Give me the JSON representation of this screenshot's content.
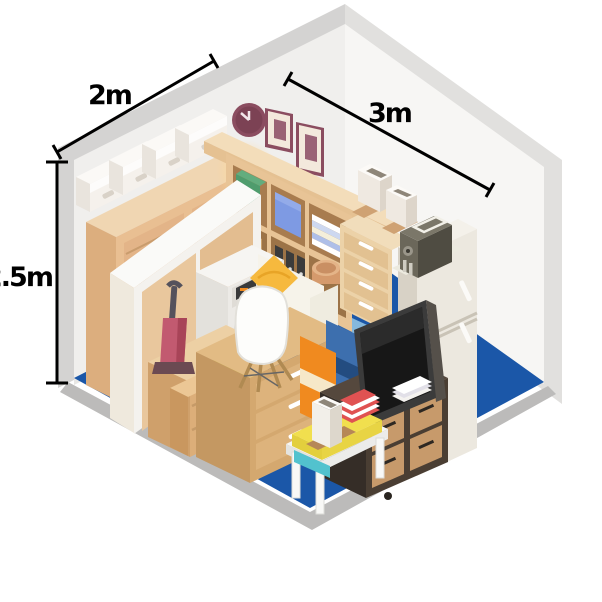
{
  "illustration": "isometric storage unit filled with household furniture and boxes",
  "dimensions": {
    "width_label": "2m",
    "depth_label": "3m",
    "height_label": "2.5m"
  },
  "colors": {
    "floor": "#1b57a8",
    "wall": "#f0efed",
    "wall_edge": "#d4d3d2",
    "wood": "#e9c195",
    "wood_dark": "#c99a68",
    "cardboard": "#d4a86f",
    "accent_yellow": "#f6b93e",
    "accent_orange": "#f08a1f",
    "accent_blue": "#3d6fae",
    "accent_teal": "#52c2ce",
    "accent_green": "#4f9c6d",
    "accent_chartreuse": "#ccd43e",
    "accent_plum": "#8b4d60",
    "appliance_white": "#eceae6",
    "fridge_cream": "#ece8df",
    "tv_dark": "#3b3b3b",
    "stand_espresso": "#4a3e33",
    "dimension_line": "#000000"
  },
  "objects": [
    "wall clock",
    "picture frames",
    "cube shelf with binders and boxes",
    "glowing lamp",
    "louvered cabinet",
    "white storage boxes",
    "sliding-door wardrobe",
    "washing machine",
    "vacuum cleaner",
    "chartreuse bin",
    "low drawer unit",
    "cream sofa with yellow pillows",
    "eames chair",
    "cardboard drawer chest",
    "suitcases",
    "tv on espresso stand",
    "tall drawer chest with planters",
    "refrigerator with appliance on top",
    "coffee table with cushions, vase and striped towels"
  ]
}
